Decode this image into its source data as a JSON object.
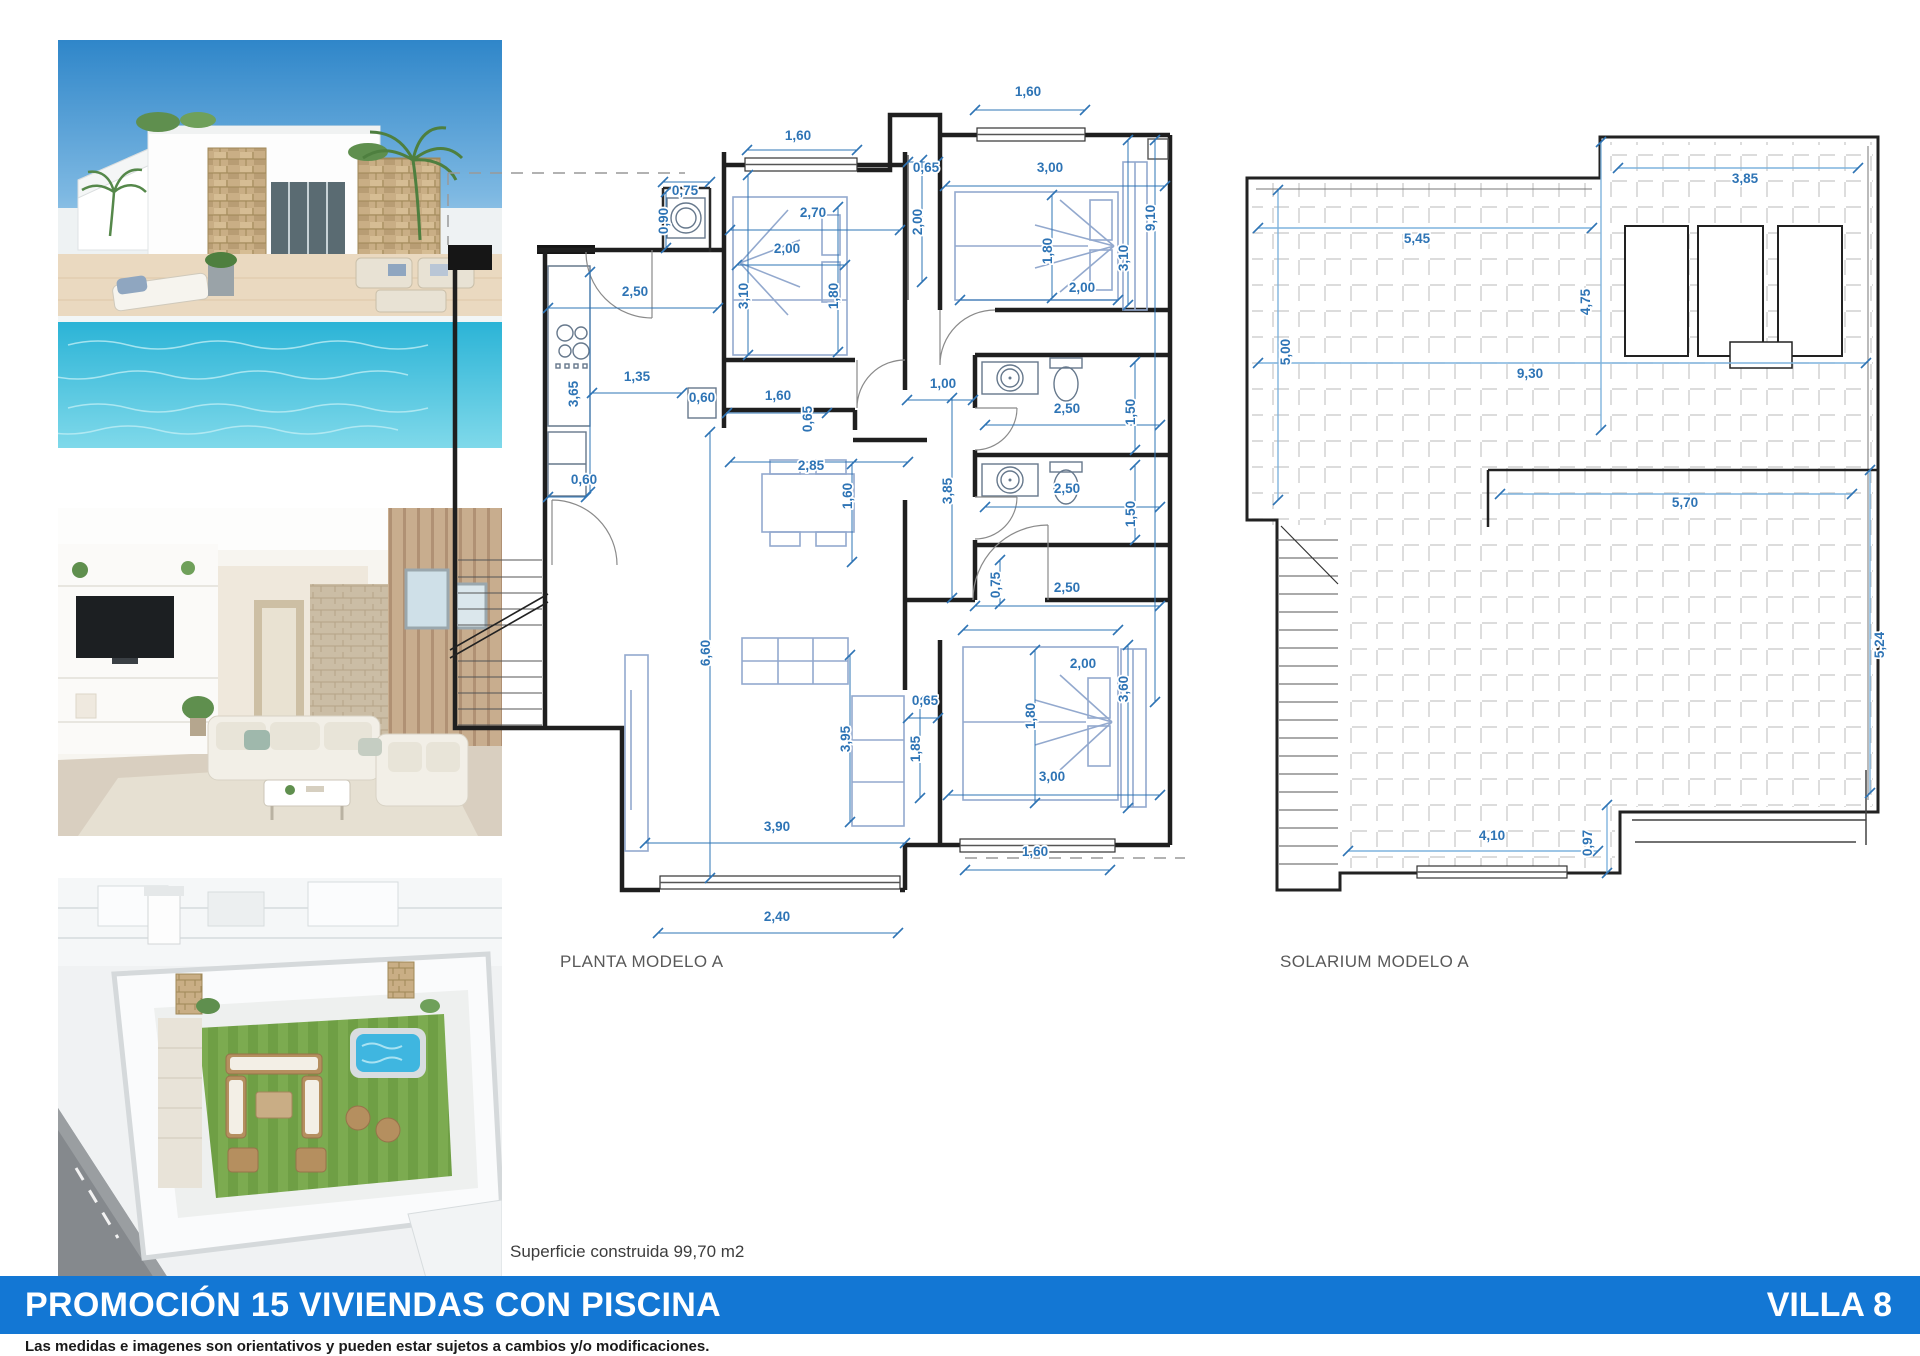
{
  "document": {
    "plans": {
      "planta": {
        "label": "PLANTA MODELO A"
      },
      "solarium": {
        "label": "SOLARIUM MODELO A"
      }
    },
    "area_note": "Superficie construida 99,70 m2",
    "banner": {
      "title": "PROMOCIÓN 15 VIVIENDAS CON PISCINA",
      "villa": "VILLA 8",
      "color": "#1377d4"
    },
    "disclaimer": "Las medidas e imagenes son orientativos y pueden estar sujetos a cambios y/o modificaciones.",
    "dim_color": "#2e74b5"
  },
  "planta_dims": [
    [
      798,
      140,
      "1,60",
      0
    ],
    [
      1028,
      96,
      "1,60",
      0
    ],
    [
      685,
      195,
      "0,75",
      0
    ],
    [
      668,
      221,
      "0,90",
      1
    ],
    [
      813,
      217,
      "2,70",
      0
    ],
    [
      926,
      172,
      "0,65",
      0
    ],
    [
      922,
      222,
      "2,00",
      1
    ],
    [
      1050,
      172,
      "3,00",
      0
    ],
    [
      787,
      253,
      "2,00",
      0
    ],
    [
      748,
      296,
      "3,10",
      1
    ],
    [
      838,
      296,
      "1,80",
      1
    ],
    [
      1052,
      251,
      "1,80",
      1
    ],
    [
      1128,
      258,
      "3,10",
      1
    ],
    [
      1155,
      218,
      "9,10",
      1
    ],
    [
      1082,
      292,
      "2,00",
      0
    ],
    [
      635,
      296,
      "2,50",
      0
    ],
    [
      578,
      394,
      "3,65",
      1
    ],
    [
      637,
      381,
      "1,35",
      0
    ],
    [
      702,
      402,
      "0,60",
      0
    ],
    [
      778,
      400,
      "1,60",
      0
    ],
    [
      812,
      419,
      "0,65",
      1
    ],
    [
      943,
      388,
      "1,00",
      0
    ],
    [
      584,
      484,
      "0,60",
      0
    ],
    [
      811,
      470,
      "2,85",
      0
    ],
    [
      852,
      496,
      "1,60",
      1
    ],
    [
      952,
      491,
      "3,85",
      1
    ],
    [
      1067,
      413,
      "2,50",
      0
    ],
    [
      1135,
      412,
      "1,50",
      1
    ],
    [
      1067,
      493,
      "2,50",
      0
    ],
    [
      1135,
      514,
      "1,50",
      1
    ],
    [
      1000,
      585,
      "0,75",
      1
    ],
    [
      1067,
      592,
      "2,50",
      0
    ],
    [
      925,
      705,
      "0,65",
      0
    ],
    [
      920,
      749,
      "1,85",
      1
    ],
    [
      850,
      739,
      "3,95",
      1
    ],
    [
      710,
      653,
      "6,60",
      1
    ],
    [
      1083,
      668,
      "2,00",
      0
    ],
    [
      1035,
      716,
      "1,80",
      1
    ],
    [
      1128,
      689,
      "3,60",
      1
    ],
    [
      1052,
      781,
      "3,00",
      0
    ],
    [
      1035,
      856,
      "1,60",
      0
    ],
    [
      777,
      831,
      "3,90",
      0
    ],
    [
      777,
      921,
      "2,40",
      0
    ]
  ],
  "planta_dimlines": [
    [
      747,
      150,
      857,
      150
    ],
    [
      975,
      110,
      1085,
      110
    ],
    [
      730,
      230,
      900,
      230
    ],
    [
      945,
      186,
      1165,
      186
    ],
    [
      548,
      308,
      718,
      308
    ],
    [
      592,
      393,
      682,
      393
    ],
    [
      645,
      843,
      905,
      843
    ],
    [
      658,
      933,
      898,
      933
    ],
    [
      965,
      870,
      1110,
      870
    ],
    [
      948,
      795,
      1160,
      795
    ],
    [
      730,
      462,
      908,
      462
    ],
    [
      710,
      432,
      710,
      878
    ],
    [
      952,
      398,
      952,
      598
    ],
    [
      852,
      464,
      852,
      562
    ],
    [
      907,
      400,
      973,
      400
    ],
    [
      985,
      425,
      1160,
      425
    ],
    [
      1135,
      362,
      1135,
      450
    ],
    [
      985,
      507,
      1160,
      507
    ],
    [
      1135,
      465,
      1135,
      540
    ],
    [
      975,
      606,
      1160,
      606
    ],
    [
      1000,
      560,
      1000,
      604
    ],
    [
      737,
      265,
      845,
      265
    ],
    [
      838,
      207,
      838,
      352
    ],
    [
      748,
      175,
      748,
      355
    ],
    [
      1052,
      195,
      1052,
      298
    ],
    [
      960,
      300,
      1118,
      300
    ],
    [
      1128,
      140,
      1128,
      305
    ],
    [
      1155,
      140,
      1155,
      702
    ],
    [
      1128,
      645,
      1128,
      808
    ],
    [
      1035,
      650,
      1035,
      803
    ],
    [
      908,
      718,
      938,
      718
    ],
    [
      920,
      700,
      920,
      798
    ],
    [
      850,
      655,
      850,
      822
    ],
    [
      590,
      272,
      590,
      492
    ],
    [
      548,
      497,
      586,
      497
    ],
    [
      727,
      413,
      827,
      413
    ],
    [
      908,
      162,
      938,
      162
    ],
    [
      922,
      160,
      922,
      282
    ],
    [
      663,
      182,
      710,
      182
    ],
    [
      666,
      192,
      666,
      248
    ],
    [
      963,
      630,
      1118,
      630
    ]
  ],
  "solarium_dims": [
    [
      1417,
      243,
      "5,45",
      0
    ],
    [
      1290,
      352,
      "5,00",
      1
    ],
    [
      1530,
      378,
      "9,30",
      0
    ],
    [
      1745,
      183,
      "3,85",
      0
    ],
    [
      1590,
      302,
      "4,75",
      1
    ],
    [
      1685,
      507,
      "5,70",
      0
    ],
    [
      1884,
      645,
      "5,24",
      1
    ],
    [
      1492,
      840,
      "4,10",
      0
    ],
    [
      1592,
      843,
      "0,97",
      1
    ]
  ],
  "solarium_dimlines": [
    [
      1258,
      228,
      1592,
      228
    ],
    [
      1618,
      168,
      1858,
      168
    ],
    [
      1258,
      363,
      1866,
      363
    ],
    [
      1278,
      190,
      1278,
      500
    ],
    [
      1601,
      142,
      1601,
      430
    ],
    [
      1500,
      494,
      1852,
      494
    ],
    [
      1870,
      470,
      1870,
      793
    ],
    [
      1348,
      851,
      1598,
      851
    ],
    [
      1607,
      805,
      1607,
      873
    ]
  ]
}
